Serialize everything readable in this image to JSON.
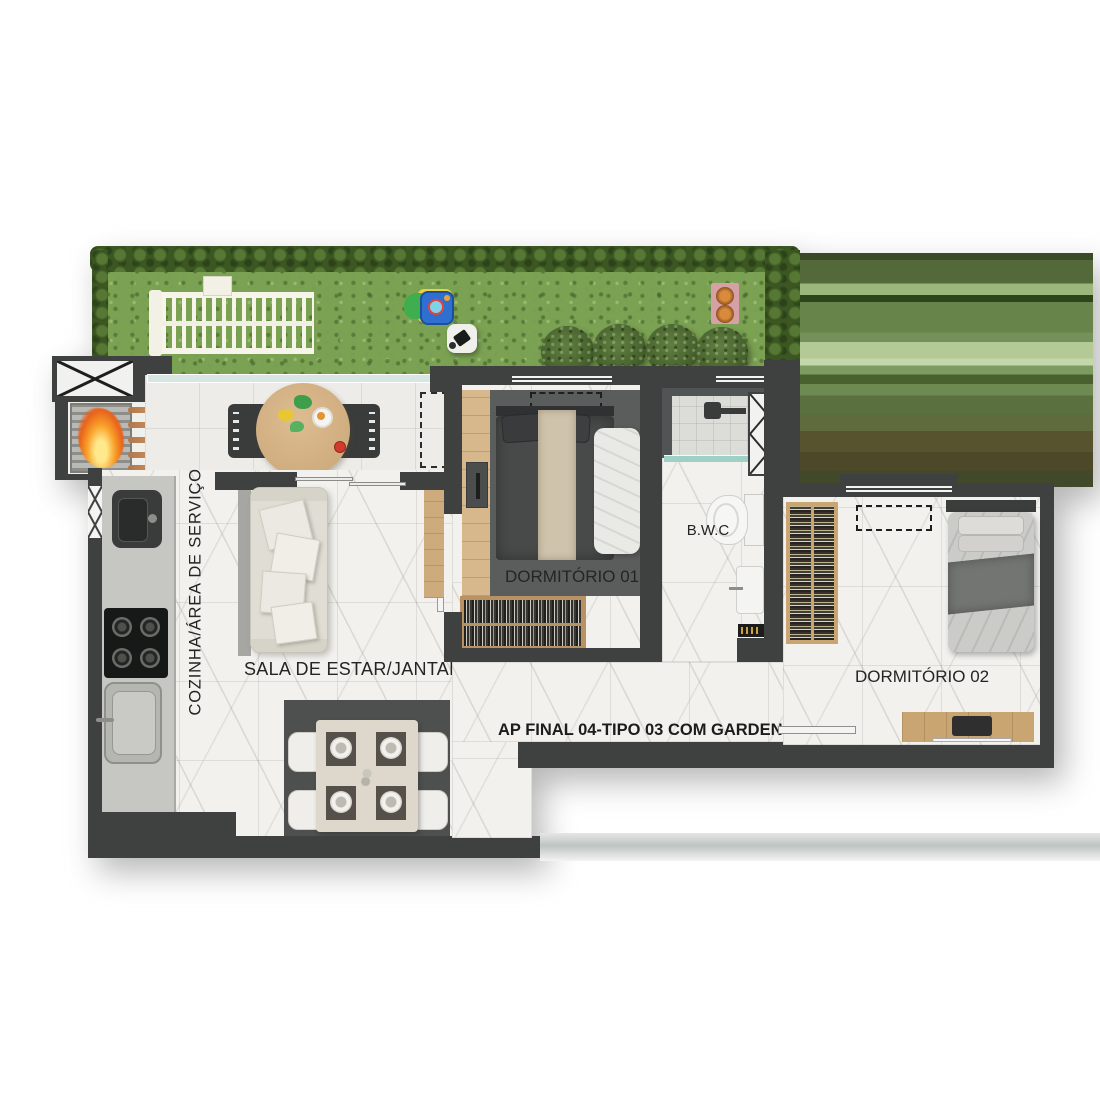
{
  "title": {
    "text": "AP FINAL 04-TIPO 03 COM GARDEN"
  },
  "rooms": {
    "kitchen": {
      "label": "COZINHA/ÁREA DE SERVIÇO"
    },
    "living": {
      "label": "SALA DE ESTAR/JANTAR"
    },
    "bedroom1": {
      "label": "DORMITÓRIO 01"
    },
    "bathroom": {
      "label": "B.W.C"
    },
    "bedroom2": {
      "label": "DORMITÓRIO 02"
    }
  },
  "colors": {
    "wall": "#3e4140",
    "grass": "#7ba152",
    "hedge": "#3c5722",
    "floor_marble": "#f2f1ee",
    "wood": "#c9a571",
    "fire": "#f59b27",
    "glass": "#d7e6e2",
    "rug": "#4e504f"
  }
}
